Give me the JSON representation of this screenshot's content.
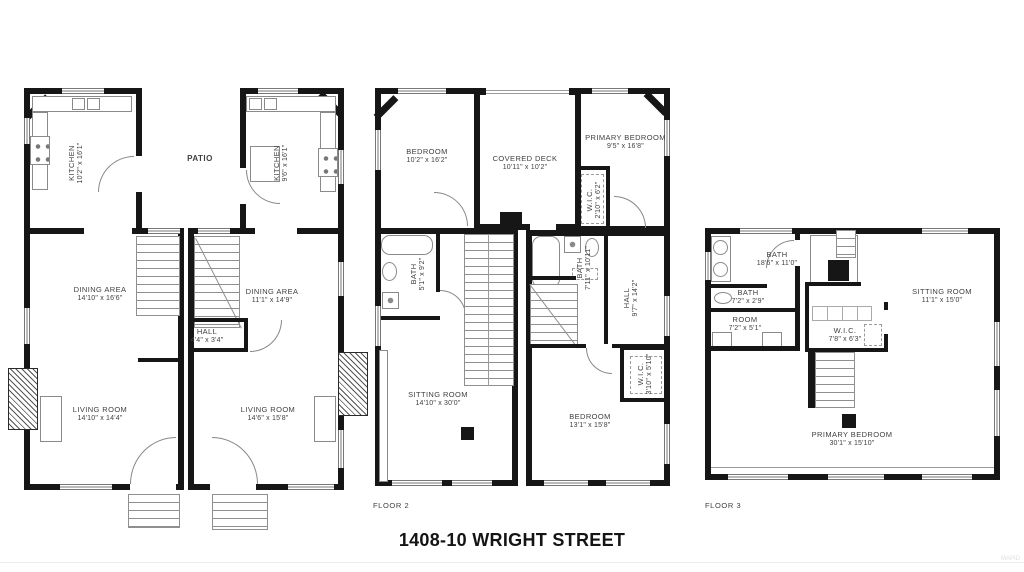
{
  "title": "1408-10 WRIGHT STREET",
  "watermark": "MAPID",
  "floor1": {
    "patio": "PATIO",
    "unit_left": {
      "kitchen": {
        "name": "KITCHEN",
        "dims": "10'2\" x 16'1\""
      },
      "dining": {
        "name": "DINING AREA",
        "dims": "14'10\" x 16'6\""
      },
      "living": {
        "name": "LIVING ROOM",
        "dims": "14'10\" x 14'4\""
      }
    },
    "unit_right": {
      "kitchen": {
        "name": "KITCHEN",
        "dims": "9'6\" x 16'1\""
      },
      "dining": {
        "name": "DINING AREA",
        "dims": "11'1\" x 14'9\""
      },
      "hall": {
        "name": "HALL",
        "dims": "4'4\" x 3'4\""
      },
      "living": {
        "name": "LIVING ROOM",
        "dims": "14'6\" x 15'8\""
      }
    }
  },
  "floor2": {
    "label": "FLOOR 2",
    "bedroom_front": {
      "name": "BEDROOM",
      "dims": "10'2\" x 16'2\""
    },
    "covered_deck": {
      "name": "COVERED DECK",
      "dims": "10'11\" x 10'2\""
    },
    "primary_bedroom": {
      "name": "PRIMARY BEDROOM",
      "dims": "9'5\" x 16'8\""
    },
    "wic_upper": {
      "name": "W.I.C.",
      "dims": "2'10\" x 6'2\""
    },
    "bath_right": {
      "name": "BATH",
      "dims": "7'11\" x 10'11\""
    },
    "bath_left": {
      "name": "BATH",
      "dims": "5'1\" x 9'2\""
    },
    "hall": {
      "name": "HALL",
      "dims": "9'7\" x 14'2\""
    },
    "sitting_room": {
      "name": "SITTING ROOM",
      "dims": "14'10\" x 30'0\""
    },
    "wic_lower": {
      "name": "W.I.C.",
      "dims": "3'10\" x 5'10\""
    },
    "bedroom_rear": {
      "name": "BEDROOM",
      "dims": "13'1\" x 15'8\""
    }
  },
  "floor3": {
    "label": "FLOOR 3",
    "bath_large": {
      "name": "BATH",
      "dims": "18'6\" x 11'0\""
    },
    "bath_small": {
      "name": "BATH",
      "dims": "7'2\" x 2'9\""
    },
    "room": {
      "name": "ROOM",
      "dims": "7'2\" x 5'1\""
    },
    "wic": {
      "name": "W.I.C.",
      "dims": "7'8\" x 6'3\""
    },
    "sitting_room": {
      "name": "SITTING ROOM",
      "dims": "11'1\" x 15'0\""
    },
    "primary_bedroom": {
      "name": "PRIMARY BEDROOM",
      "dims": "30'1\" x 15'10\""
    }
  }
}
